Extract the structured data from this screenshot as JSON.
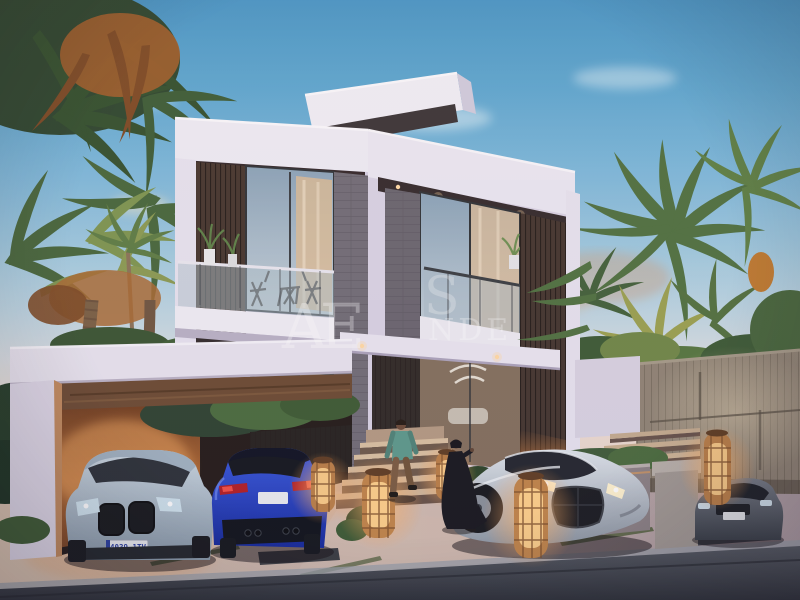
{
  "scene": {
    "type": "architectural dusk rendering",
    "description": "Modern two-storey white luxury villa at dusk with glass balconies, wood slats and stone piers, flanked by palm trees; carport pergola on the left with a silver coupe and a blue sedan, a silver hypercar and a dark grey car on the right driveway, a man on the entrance steps, a woman in a black abaya, glowing rattan lanterns, wooden fence and asphalt road in front",
    "time_of_day": "dusk"
  },
  "watermark": {
    "main": "AE",
    "fragment_top": "S",
    "fragment_bottom": "NDE",
    "color": "#ffffff",
    "opacity": 0.32
  },
  "license_plates": {
    "silver_coupe": "4039 1TV"
  },
  "objects": {
    "cars": [
      {
        "name": "silver-coupe",
        "color": "#b3c2cf",
        "view": "front, parked under pergola"
      },
      {
        "name": "blue-sedan",
        "color": "#2746cb",
        "view": "rear, parked under pergola"
      },
      {
        "name": "silver-hypercar",
        "color": "#c9d0d8",
        "view": "front three-quarter on driveway"
      },
      {
        "name": "grey-car",
        "color": "#565c66",
        "view": "front, far right by fence"
      }
    ],
    "people": [
      {
        "name": "man-on-steps",
        "clothing": "teal shirt, brown trousers"
      },
      {
        "name": "woman-in-abaya",
        "clothing": "black abaya"
      }
    ],
    "lanterns_count": 5,
    "palms": "dense palm clusters left and right, date palm with orange fruit"
  },
  "palette": {
    "sky_top": "#4893c4",
    "sky_horizon": "#ecddd2",
    "wall_light": "#efecf6",
    "wall_shadow": "#c9c2d8",
    "soffit": "#352b2c",
    "wood_slat": "#46362e",
    "stone": "#716c76",
    "glass": "#9fb4c5",
    "curtain_glow": "#dcbb95",
    "warm_glow": "#d98a4e",
    "palm_dark": "#2f4a33",
    "palm_light": "#7d9450",
    "rust_frond": "#a2602d",
    "fence": "#8f8374",
    "pavement": "#cdb9ab",
    "road": "#454a52",
    "lantern": "#c08448",
    "abaya": "#17171d",
    "shirt": "#5c988a"
  }
}
